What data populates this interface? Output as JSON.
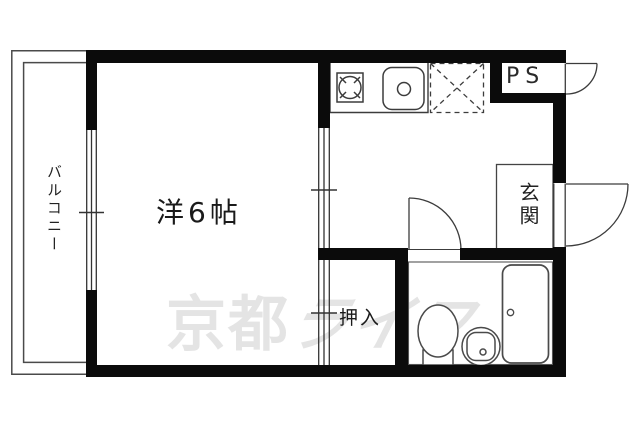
{
  "meta": {
    "kind": "japanese-apartment-floorplan",
    "canvas": {
      "width": 640,
      "height": 427
    },
    "background": "#ffffff"
  },
  "colors": {
    "wall": "#0b0b0b",
    "thin_line": "#3c3c3c",
    "fixture_line": "#4a4a4a",
    "watermark": "#e4e4e4",
    "text": "#1a1a1a"
  },
  "labels": {
    "balcony": "バルコニー",
    "room": "洋6帖",
    "closet": "押入",
    "entrance": "玄関",
    "pipe_space": "PS",
    "watermark_bold": "京都",
    "watermark_italic": "ライフ"
  },
  "fixtures": [
    {
      "name": "stove"
    },
    {
      "name": "kitchen-sink"
    },
    {
      "name": "refrigerator-space"
    },
    {
      "name": "toilet"
    },
    {
      "name": "wash-basin"
    },
    {
      "name": "bathtub"
    }
  ],
  "doors": [
    {
      "name": "ps-door"
    },
    {
      "name": "entrance-door"
    },
    {
      "name": "toilet-bath-door"
    }
  ],
  "windows": [
    {
      "name": "balcony-window"
    },
    {
      "name": "room-partition-upper"
    },
    {
      "name": "room-partition-lower"
    }
  ]
}
